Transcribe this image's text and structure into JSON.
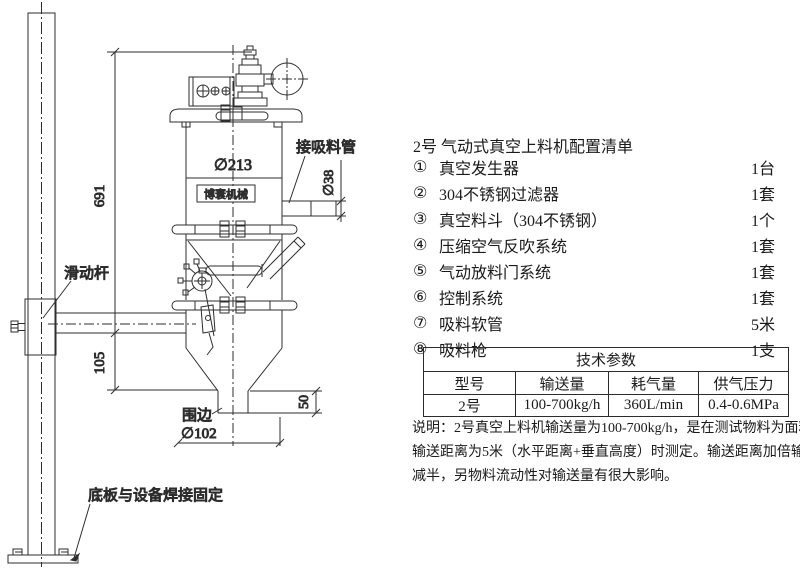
{
  "drawing": {
    "labels": {
      "dim_total_height": "691",
      "dim_arm_height": "105",
      "dim_body_dia": "∅213",
      "dim_inlet_dia": "∅38",
      "dim_skirt_height": "50",
      "dim_outlet_dia": "∅102",
      "suction_pipe_label": "接吸料管",
      "sliding_rod_label": "滑动杆",
      "skirt_label": "围边",
      "base_weld_label": "底板与设备焊接固定",
      "logo": "博寰机械"
    }
  },
  "parts_list": {
    "title": "2号 气动式真空上料机配置清单",
    "items": [
      {
        "no": "①",
        "name": "真空发生器",
        "qty": "1台"
      },
      {
        "no": "②",
        "name": "304不锈钢过滤器",
        "qty": "1套"
      },
      {
        "no": "③",
        "name": "真空料斗（304不锈钢）",
        "qty": "1个"
      },
      {
        "no": "④",
        "name": "压缩空气反吹系统",
        "qty": "1套"
      },
      {
        "no": "⑤",
        "name": "气动放料门系统",
        "qty": "1套"
      },
      {
        "no": "⑥",
        "name": "控制系统",
        "qty": "1套"
      },
      {
        "no": "⑦",
        "name": "吸料软管",
        "qty": "5米"
      },
      {
        "no": "⑧",
        "name": "吸料枪",
        "qty": "1支"
      }
    ]
  },
  "spec_table": {
    "title": "技术参数",
    "headers": [
      "型号",
      "输送量",
      "耗气量",
      "供气压力"
    ],
    "row": [
      "2号",
      "100-700kg/h",
      "360L/min",
      "0.4-0.6MPa"
    ]
  },
  "note": {
    "line1": "说明：2号真空上料机输送量为100-700kg/h，是在测试物料为面粉，",
    "line2": "输送距离为5米（水平距离+垂直高度）时测定。输送距离加倍输送量",
    "line3": "减半，另物料流动性对输送量有很大影响。"
  }
}
